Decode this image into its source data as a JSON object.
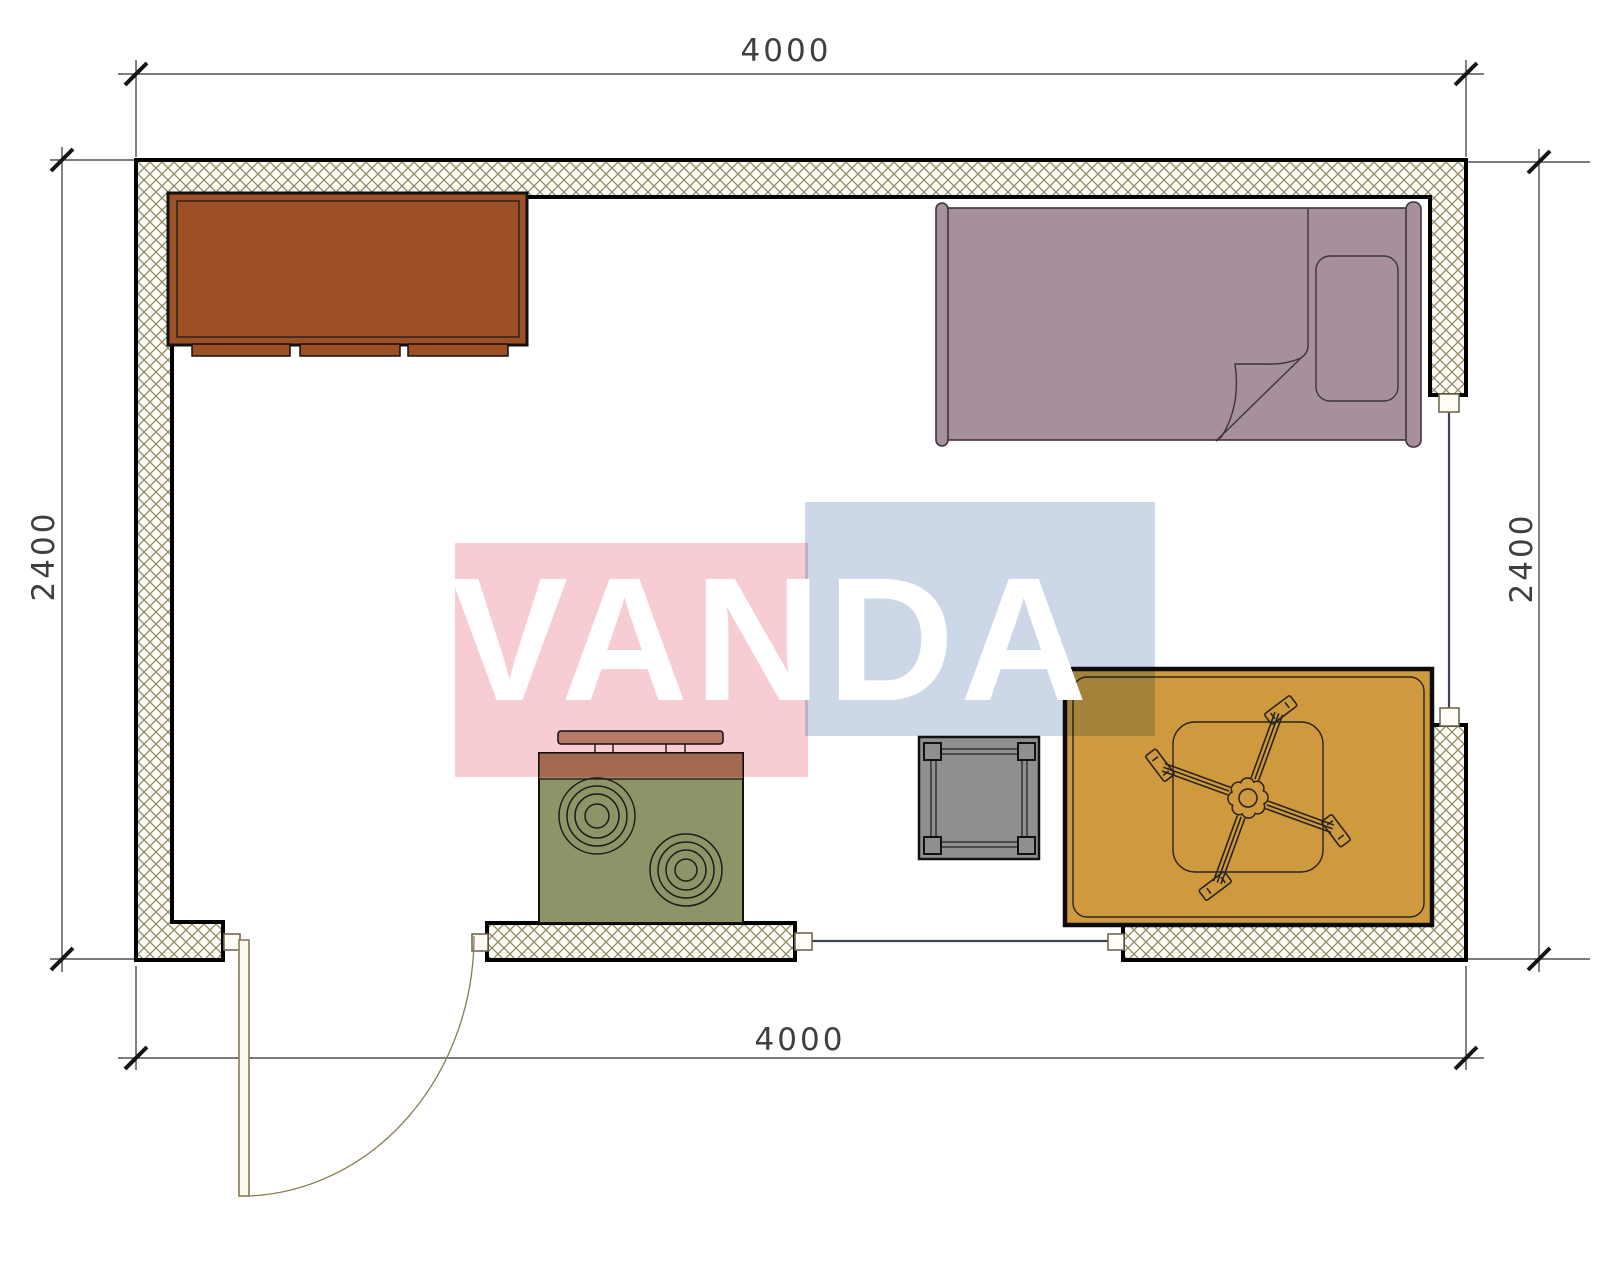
{
  "title": "room-floor-plan",
  "watermark": {
    "text": "VANDA"
  },
  "dimensions": {
    "top": "4000",
    "bottom": "4000",
    "left": "2400",
    "right": "2400"
  },
  "colors": {
    "wall_hatch_line": "#8d855f",
    "wall_hatch_bg": "#fdfcf6",
    "wall_outline": "#000000",
    "cabinet": "#9d5026",
    "bed": "#a88f9c",
    "stove_body": "#8f9468",
    "stove_band": "#a9855f",
    "stove_shelf": "#bb9878",
    "side_table": "#8f8f8f",
    "rug": "#cf9a3e",
    "door": "#8a7a55",
    "window_line": "#3c4354",
    "dimension_line": "#2f2f2f",
    "watermark_pink": "#f7ccd3",
    "watermark_blue": "#ccd8e8",
    "watermark_text": "#ffffff"
  },
  "objects": [
    "exterior-walls",
    "door",
    "window-bottom",
    "window-right",
    "cabinet",
    "single-bed",
    "pillow",
    "stove",
    "range-shelf",
    "side-table",
    "rug",
    "ceiling-fan"
  ]
}
